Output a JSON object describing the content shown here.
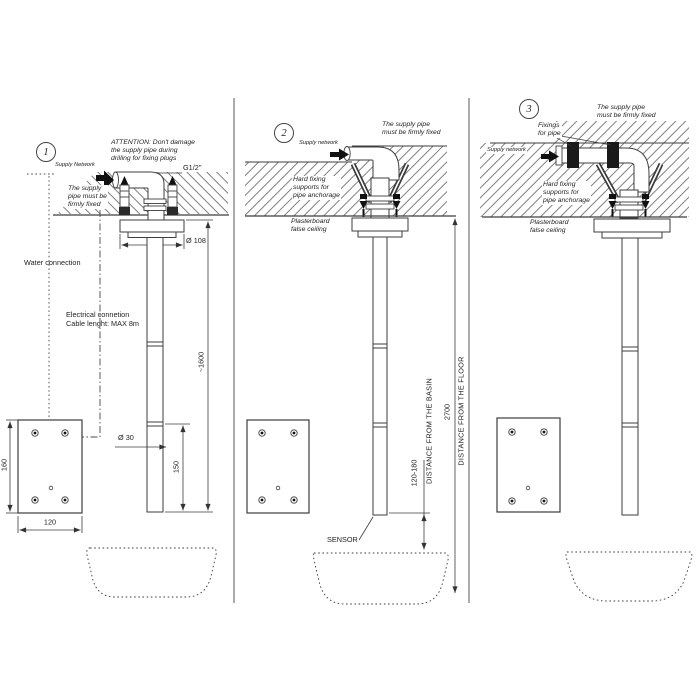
{
  "p1": {
    "num": "1",
    "attention": "ATTENTION: Don't damage\nthe supply pipe during\ndrilling for fixing plugs",
    "supply_network": "Supply Network",
    "pipe_note": "The supply\npipe must be\nfirmly fixed",
    "g": "G1/2\"",
    "d108": "Ø 108",
    "water": "Water connection",
    "electrical": "Electrical connetion\nCable lenght: MAX 8m",
    "h1600": "~1600",
    "d30": "Ø 30",
    "l150": "150",
    "p160": "160",
    "p120": "120"
  },
  "p2": {
    "num": "2",
    "supply_network": "Supply network",
    "pipe_note": "The supply pipe\nmust be firmly fixed",
    "hard_fixing": "Hard fixing\nsupports for\npipe anchorage",
    "plasterboard": "Plasterboard\nfalse ceiling",
    "sensor": "SENSOR",
    "basin_range": "120-180",
    "basin_label": "DISTANCE FROM THE BASIN",
    "floor_value": "2700",
    "floor_label": "DISTANCE FROM THE FLOOR"
  },
  "p3": {
    "num": "3",
    "pipe_note": "The supply pipe\nmust be firmly fixed",
    "fixings": "Fixings\nfor pipe",
    "supply_network": "Supply network",
    "hard_fixing": "Hard fixing\nsupports for\npipe anchorage",
    "plasterboard": "Plasterboard\nfalse ceiling"
  }
}
